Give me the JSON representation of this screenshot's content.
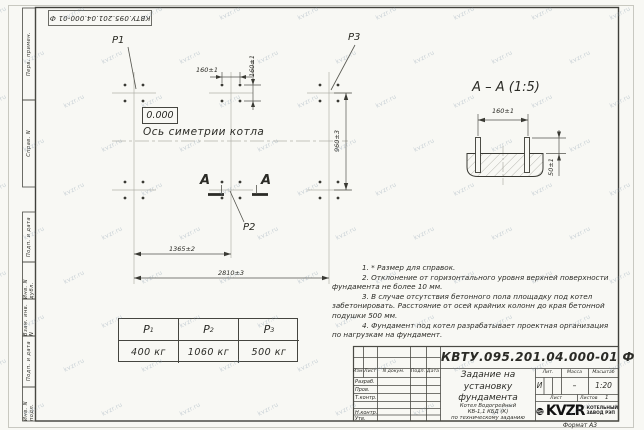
{
  "sheet": {
    "stamp_number_top": "КВТУ.095.201.04.000-01 Ф",
    "format_label": "Формат А3",
    "watermark_text": "kvzr.ru"
  },
  "margin_labels": [
    "Перв. примен.",
    "Справ. N",
    "Подп. и дата",
    "Инв. N дубл.",
    "Взам. инв. N",
    "Подп. и дата",
    "Инв. N подл."
  ],
  "plan": {
    "p1_label": "P1",
    "p2_label": "P2",
    "p3_label": "P3",
    "elevation": "0.000",
    "axis_label": "Ось симетрии котла",
    "section_letter": "А",
    "dim_160_h": "160±1",
    "dim_160_v": "160±1",
    "dim_960": "960±3",
    "dim_1365": "1365±2",
    "dim_2810": "2810±3"
  },
  "section_view": {
    "title": "А – А (1:5)",
    "dim_160": "160±1",
    "dim_50": "50±1"
  },
  "notes": [
    "1. * Размер для справок.",
    "2. Отклонение от горизонтального уровня верхней поверхности",
    "фундамента не более 10 мм.",
    "3. В случае отсутствия бетонного пола площадку под котел",
    "забетонировать. Расстояние от осей крайних колонн до края бетонной",
    "подушки 500 мм.",
    "4. Фундамент под котел разрабатывает проектная организация",
    "по нагрузкам на фундамент."
  ],
  "load_table": {
    "headers": [
      {
        "base": "P",
        "sub": "1"
      },
      {
        "base": "P",
        "sub": "2"
      },
      {
        "base": "P",
        "sub": "3"
      }
    ],
    "values": [
      "400 кг",
      "1060 кг",
      "500 кг"
    ]
  },
  "title_block": {
    "doc_number": "КВТУ.095.201.04.000-01 Ф",
    "title_lines": [
      "Задание на",
      "установку",
      "фундамента"
    ],
    "product_lines": [
      "Котел Водогрейный",
      "КВ-1,1 КБД (К)",
      "по техническому заданию"
    ],
    "col_headers": [
      "Изм.",
      "Лист",
      "N докум.",
      "Подп.",
      "Дата"
    ],
    "row_labels": [
      "Разраб.",
      "Пров.",
      "Т.контр.",
      "",
      "Н.контр.",
      "Утв."
    ],
    "lit_header": "Лит.",
    "mass_header": "Масса",
    "scale_header": "Масштаб",
    "lit_value": "И",
    "mass_value": "–",
    "scale_value": "1:20",
    "sheet_label": "Лист",
    "sheets_label": "Листов",
    "sheets_value": "1",
    "logo_text": "KVZR",
    "company_lines": [
      "КОТЕЛЬНЫЙ",
      "ЗАВОД РЭП"
    ]
  }
}
